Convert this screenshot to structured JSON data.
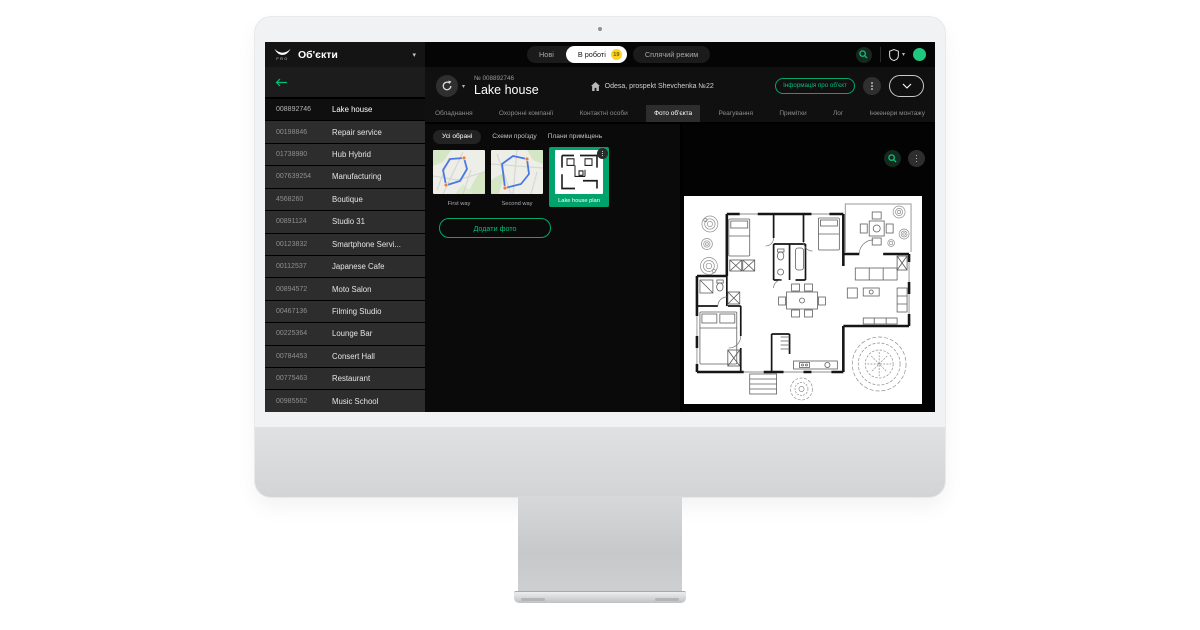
{
  "colors": {
    "accent_green": "#00b074",
    "badge_yellow": "#ffd21e",
    "avatar_green": "#1ec97d"
  },
  "icons": {
    "logo": "wings-pro-logo",
    "title_caret": "chevron-down",
    "search": "magnifier",
    "account": "shield",
    "user_status": "green-dot",
    "back": "arrow-left",
    "refresh": "circular-arrow",
    "home": "house",
    "menu": "kebab-dots",
    "collapse": "chevron-down"
  },
  "topbar": {
    "logo_sub": "PRO",
    "title": "Об'єкти",
    "tabs": [
      {
        "label": "Нові",
        "active": false,
        "grouped": true
      },
      {
        "label": "В роботі",
        "active": true,
        "grouped": true,
        "badge": "19"
      },
      {
        "label": "Сплячий режим",
        "active": false,
        "grouped": false
      }
    ]
  },
  "sidebar": {
    "items": [
      {
        "id": "008892746",
        "name": "Lake house",
        "selected": true
      },
      {
        "id": "00198846",
        "name": "Repair service"
      },
      {
        "id": "01738980",
        "name": "Hub Hybrid"
      },
      {
        "id": "007639254",
        "name": "Manufacturing"
      },
      {
        "id": "4568260",
        "name": "Boutique"
      },
      {
        "id": "00891124",
        "name": "Studio 31"
      },
      {
        "id": "00123832",
        "name": "Smartphone Servi..."
      },
      {
        "id": "00112537",
        "name": "Japanese Cafe"
      },
      {
        "id": "00894572",
        "name": "Moto Salon"
      },
      {
        "id": "00467136",
        "name": "Filming Studio"
      },
      {
        "id": "00225364",
        "name": "Lounge Bar"
      },
      {
        "id": "00784453",
        "name": "Consert Hall"
      },
      {
        "id": "00775463",
        "name": "Restaurant"
      },
      {
        "id": "00985562",
        "name": "Music School"
      }
    ]
  },
  "object_header": {
    "number": "№ 008892746",
    "title": "Lake house",
    "address": "Odesa, prospekt Shevchenka №22",
    "info_button": "Інформація про об'єкт"
  },
  "main_tabs": [
    {
      "label": "Обладнання",
      "active": false
    },
    {
      "label": "Охоронні компанії",
      "active": false
    },
    {
      "label": "Контактні особи",
      "active": false
    },
    {
      "label": "Фото об'єкта",
      "active": true
    },
    {
      "label": "Реагування",
      "active": false
    },
    {
      "label": "Примітки",
      "active": false
    },
    {
      "label": "Лог",
      "active": false
    },
    {
      "label": "Інженери монтажу",
      "active": false
    }
  ],
  "photo_section": {
    "filters": [
      {
        "label": "Усі обрані",
        "active": true
      },
      {
        "label": "Схеми проїзду",
        "active": false
      },
      {
        "label": "Плани приміщень",
        "active": false
      }
    ],
    "photos": [
      {
        "label": "First way",
        "kind": "map1",
        "selected": false
      },
      {
        "label": "Second way",
        "kind": "map2",
        "selected": false
      },
      {
        "label": "Lake house plan",
        "kind": "plan",
        "selected": true
      }
    ],
    "add_button": "Додати фото"
  }
}
